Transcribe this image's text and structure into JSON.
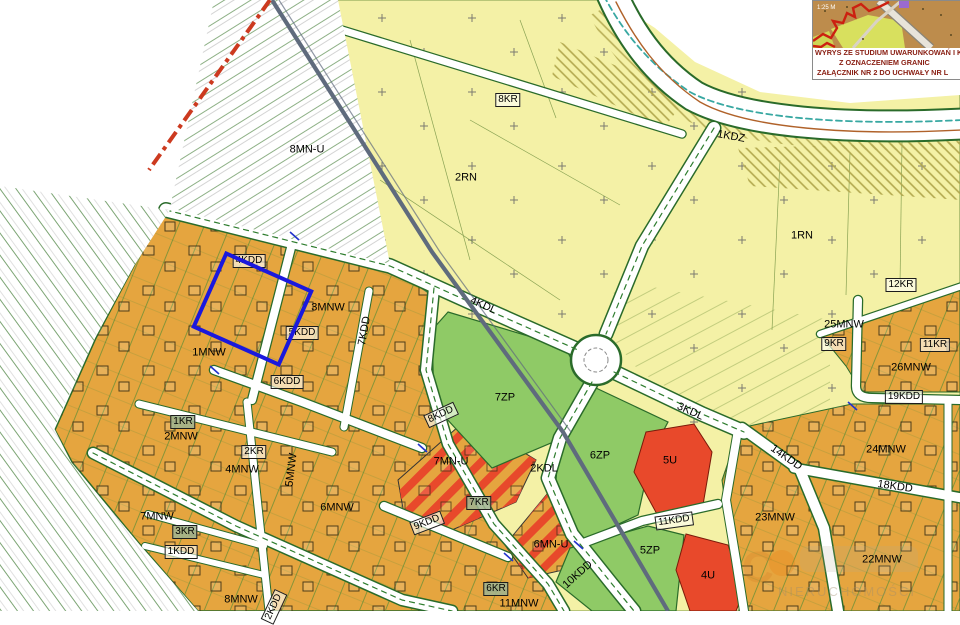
{
  "colors": {
    "zone_yellow": "#f4f1a6",
    "zone_orange": "#e5a53f",
    "zone_green": "#8fca66",
    "zone_red": "#e8492b",
    "road_edge_green": "#2a6b2a",
    "selection_blue": "#1a18dd",
    "boundary_red": "#cc3a1f",
    "powerline_gray": "#5f6b7d",
    "caption_maroon": "#8a2014"
  },
  "labels": [
    {
      "text": "8MN-U",
      "x": 307,
      "y": 150,
      "style": "plain",
      "rot": 0
    },
    {
      "text": "2RN",
      "x": 466,
      "y": 178,
      "style": "plain",
      "rot": 0
    },
    {
      "text": "8KR",
      "x": 508,
      "y": 100,
      "style": "boxed",
      "rot": 0
    },
    {
      "text": "1KDZ",
      "x": 731,
      "y": 137,
      "style": "plain",
      "rot": 10
    },
    {
      "text": "1RN",
      "x": 802,
      "y": 236,
      "style": "plain",
      "rot": 0
    },
    {
      "text": "12KR",
      "x": 901,
      "y": 285,
      "style": "boxed",
      "rot": 0
    },
    {
      "text": "25MNW",
      "x": 844,
      "y": 325,
      "style": "plain",
      "rot": 0
    },
    {
      "text": "9KR",
      "x": 834,
      "y": 344,
      "style": "boxed",
      "rot": 0
    },
    {
      "text": "11KR",
      "x": 935,
      "y": 345,
      "style": "boxed",
      "rot": 0
    },
    {
      "text": "26MNW",
      "x": 911,
      "y": 368,
      "style": "plain",
      "rot": 0
    },
    {
      "text": "19KDD",
      "x": 904,
      "y": 397,
      "style": "boxed",
      "rot": 0
    },
    {
      "text": "24MNW",
      "x": 886,
      "y": 450,
      "style": "plain",
      "rot": 0
    },
    {
      "text": "18KDD",
      "x": 895,
      "y": 487,
      "style": "plain",
      "rot": 8
    },
    {
      "text": "14KDD",
      "x": 786,
      "y": 458,
      "style": "plain",
      "rot": 35
    },
    {
      "text": "22MNW",
      "x": 882,
      "y": 560,
      "style": "plain",
      "rot": 0
    },
    {
      "text": "23MNW",
      "x": 775,
      "y": 518,
      "style": "plain",
      "rot": 0
    },
    {
      "text": "4KDD",
      "x": 249,
      "y": 261,
      "style": "boxed",
      "rot": 0
    },
    {
      "text": "3MNW",
      "x": 328,
      "y": 308,
      "style": "plain",
      "rot": 0
    },
    {
      "text": "5KDD",
      "x": 302,
      "y": 333,
      "style": "boxed",
      "rot": 0
    },
    {
      "text": "1MNW",
      "x": 209,
      "y": 353,
      "style": "plain",
      "rot": 0
    },
    {
      "text": "6KDD",
      "x": 287,
      "y": 382,
      "style": "boxed",
      "rot": 0
    },
    {
      "text": "7KDD",
      "x": 365,
      "y": 331,
      "style": "plain",
      "rot": -80
    },
    {
      "text": "4KDL",
      "x": 483,
      "y": 306,
      "style": "plain",
      "rot": 24
    },
    {
      "text": "7ZP",
      "x": 505,
      "y": 398,
      "style": "plain",
      "rot": 0
    },
    {
      "text": "8KDD",
      "x": 441,
      "y": 415,
      "style": "boxed",
      "rot": -25
    },
    {
      "text": "2MNW",
      "x": 181,
      "y": 437,
      "style": "plain",
      "rot": 0
    },
    {
      "text": "1KR",
      "x": 183,
      "y": 422,
      "style": "boxedgreen",
      "rot": 0
    },
    {
      "text": "2KR",
      "x": 254,
      "y": 452,
      "style": "boxed",
      "rot": 0
    },
    {
      "text": "4MNW",
      "x": 242,
      "y": 470,
      "style": "plain",
      "rot": 0
    },
    {
      "text": "5MNW",
      "x": 292,
      "y": 470,
      "style": "plain",
      "rot": -83
    },
    {
      "text": "6MNW",
      "x": 337,
      "y": 508,
      "style": "plain",
      "rot": 0
    },
    {
      "text": "7MNW",
      "x": 157,
      "y": 517,
      "style": "plain",
      "rot": 0
    },
    {
      "text": "3KR",
      "x": 185,
      "y": 532,
      "style": "boxedgreen",
      "rot": 0
    },
    {
      "text": "1KDD",
      "x": 181,
      "y": 552,
      "style": "boxed",
      "rot": 0
    },
    {
      "text": "8MNW",
      "x": 241,
      "y": 600,
      "style": "plain",
      "rot": 0
    },
    {
      "text": "7MN-U",
      "x": 451,
      "y": 462,
      "style": "plain",
      "rot": 0
    },
    {
      "text": "7KR",
      "x": 479,
      "y": 503,
      "style": "boxedgreen",
      "rot": 0
    },
    {
      "text": "9KDD",
      "x": 427,
      "y": 523,
      "style": "boxed",
      "rot": -21
    },
    {
      "text": "2KDL",
      "x": 544,
      "y": 469,
      "style": "plain",
      "rot": 0
    },
    {
      "text": "6MN-U",
      "x": 551,
      "y": 545,
      "style": "plain",
      "rot": 0
    },
    {
      "text": "10KDD",
      "x": 578,
      "y": 575,
      "style": "plain",
      "rot": -42
    },
    {
      "text": "6ZP",
      "x": 600,
      "y": 456,
      "style": "plain",
      "rot": 0
    },
    {
      "text": "5U",
      "x": 670,
      "y": 461,
      "style": "plain",
      "rot": 0
    },
    {
      "text": "3KDL",
      "x": 690,
      "y": 412,
      "style": "plain",
      "rot": 24
    },
    {
      "text": "11KDD",
      "x": 674,
      "y": 521,
      "style": "boxed",
      "rot": -8
    },
    {
      "text": "5ZP",
      "x": 650,
      "y": 551,
      "style": "plain",
      "rot": 0
    },
    {
      "text": "4U",
      "x": 708,
      "y": 576,
      "style": "plain",
      "rot": 0
    },
    {
      "text": "6KR",
      "x": 496,
      "y": 589,
      "style": "boxedgreen",
      "rot": 0
    },
    {
      "text": "11MNW",
      "x": 519,
      "y": 604,
      "style": "plain",
      "rot": 0
    },
    {
      "text": "2KDD",
      "x": 274,
      "y": 607,
      "style": "boxed",
      "rot": -65
    }
  ],
  "inset": {
    "scale_text": "1:25 M",
    "caption_line1": "WYRYS ZE STUDIUM UWARUNKOWAŃ I KI",
    "caption_line2": "Z OZNACZENIEM GRANIC",
    "caption_line3": "ZAŁĄCZNIK NR 2 DO UCHWAŁY NR L"
  },
  "watermark": {
    "logo_letter": "C",
    "text": "NIERUCHOMOŚCI"
  }
}
